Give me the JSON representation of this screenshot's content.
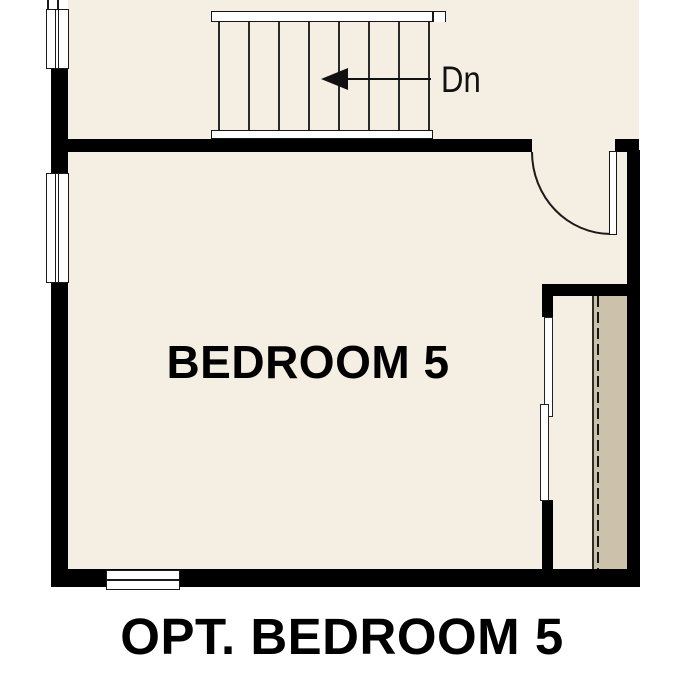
{
  "room": {
    "label": "BEDROOM 5"
  },
  "caption": "OPT. BEDROOM 5",
  "stairs": {
    "direction_label": "Dn",
    "arrow_points": "left",
    "tread_line_count": 8
  },
  "colors": {
    "background": "#ffffff",
    "floor": "#f5eee2",
    "closet_shelf": "#ccc1ab",
    "wall": "#000000",
    "line": "#1a1a1a"
  }
}
